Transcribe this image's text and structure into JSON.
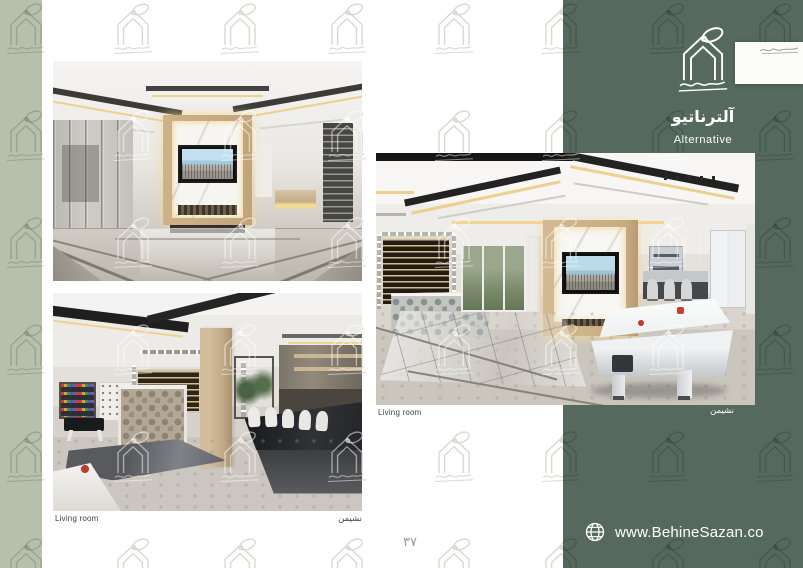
{
  "brand": {
    "title_fa": "آلترناتیو",
    "title_en": "Alternative",
    "website": "www.BehineSazan.co"
  },
  "page": {
    "number": "۳۷"
  },
  "figures": {
    "top_left": {
      "name": "living-room-render-1"
    },
    "bottom_left": {
      "name": "living-room-render-2",
      "caption_en": "Living room",
      "caption_fa": "نشیمن"
    },
    "center": {
      "name": "living-room-render-3",
      "caption_en": "Living room",
      "caption_fa": "نشیمن"
    }
  },
  "colors": {
    "panel_green": "#56695e",
    "sage": "#b6c1ab",
    "warm_accent": "#ecd08d",
    "watermark_gray": "#d8d8d5",
    "text_dark": "#3f3f3f",
    "text_white": "#ffffff"
  },
  "icons": {
    "footer": "globe-icon",
    "brand_mark": "house-logo-icon",
    "brand_halo": "halo-swirl-icon",
    "brand_signature": "signature-scribble-icon",
    "watermark": "brand-watermark-icon"
  }
}
